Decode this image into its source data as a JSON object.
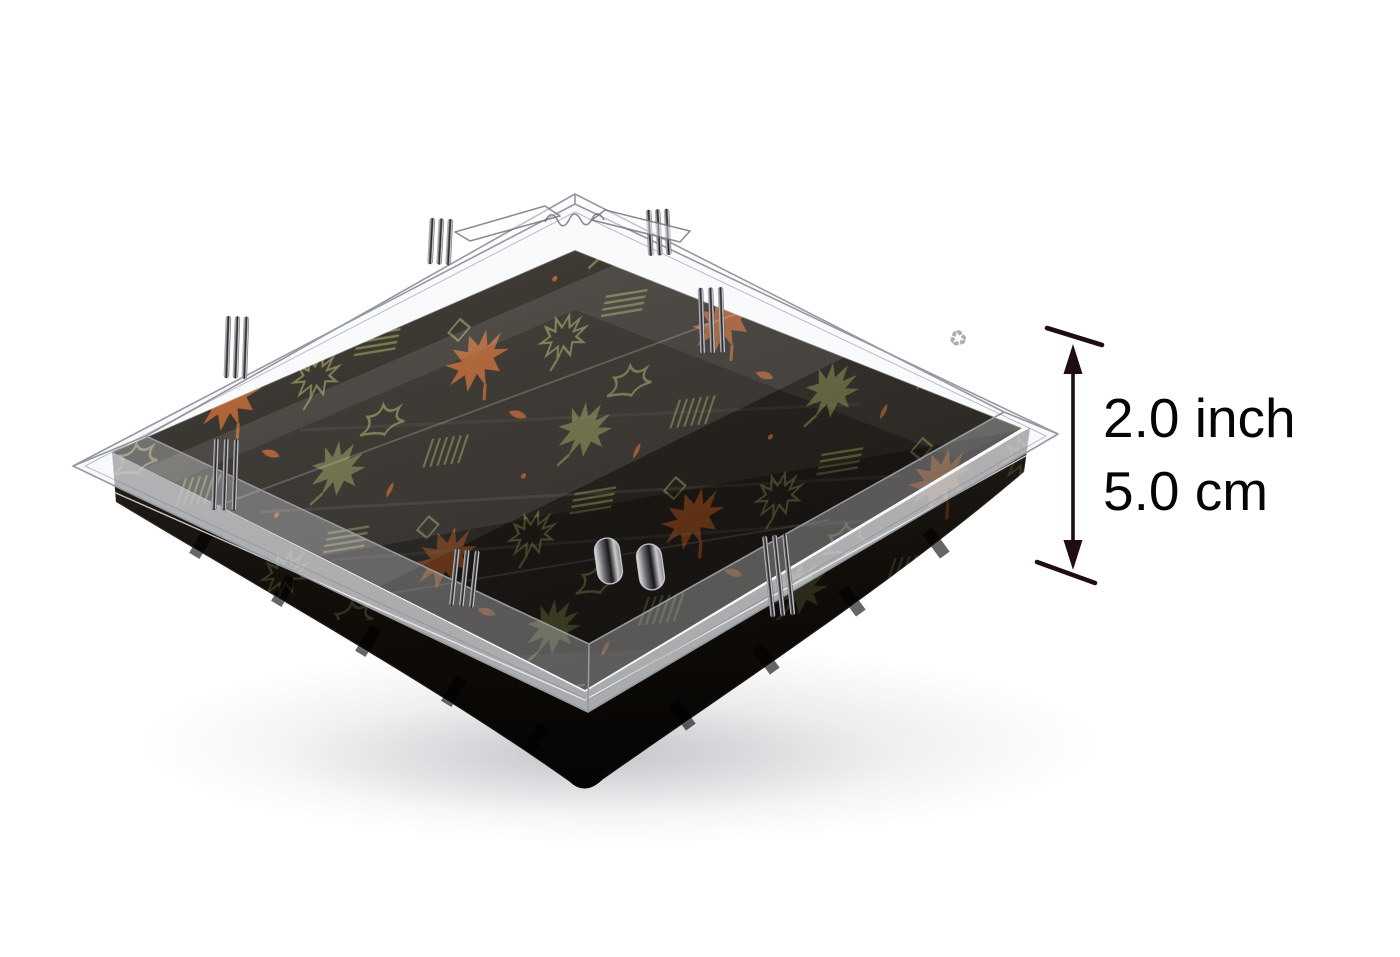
{
  "page": {
    "background_color": "#ffffff"
  },
  "annotation": {
    "height_inch": "2.0 inch",
    "height_cm": "5.0 cm",
    "arrow_color": "#200d13",
    "text_color": "#050505"
  },
  "product": {
    "description": "Black square sushi tray with clear anti-fog lid, printed with autumn maple leaf (momiji) pattern",
    "colors": {
      "base_black": "#17120d",
      "interior_brown": "#37312a",
      "leaf_orange": "#dd7331",
      "leaf_olive": "#8e9054",
      "leaf_outline_olive": "#9c9c62",
      "lid_line_gray": "#9598a0"
    },
    "icons": {
      "recycle_mark": "♻"
    }
  }
}
